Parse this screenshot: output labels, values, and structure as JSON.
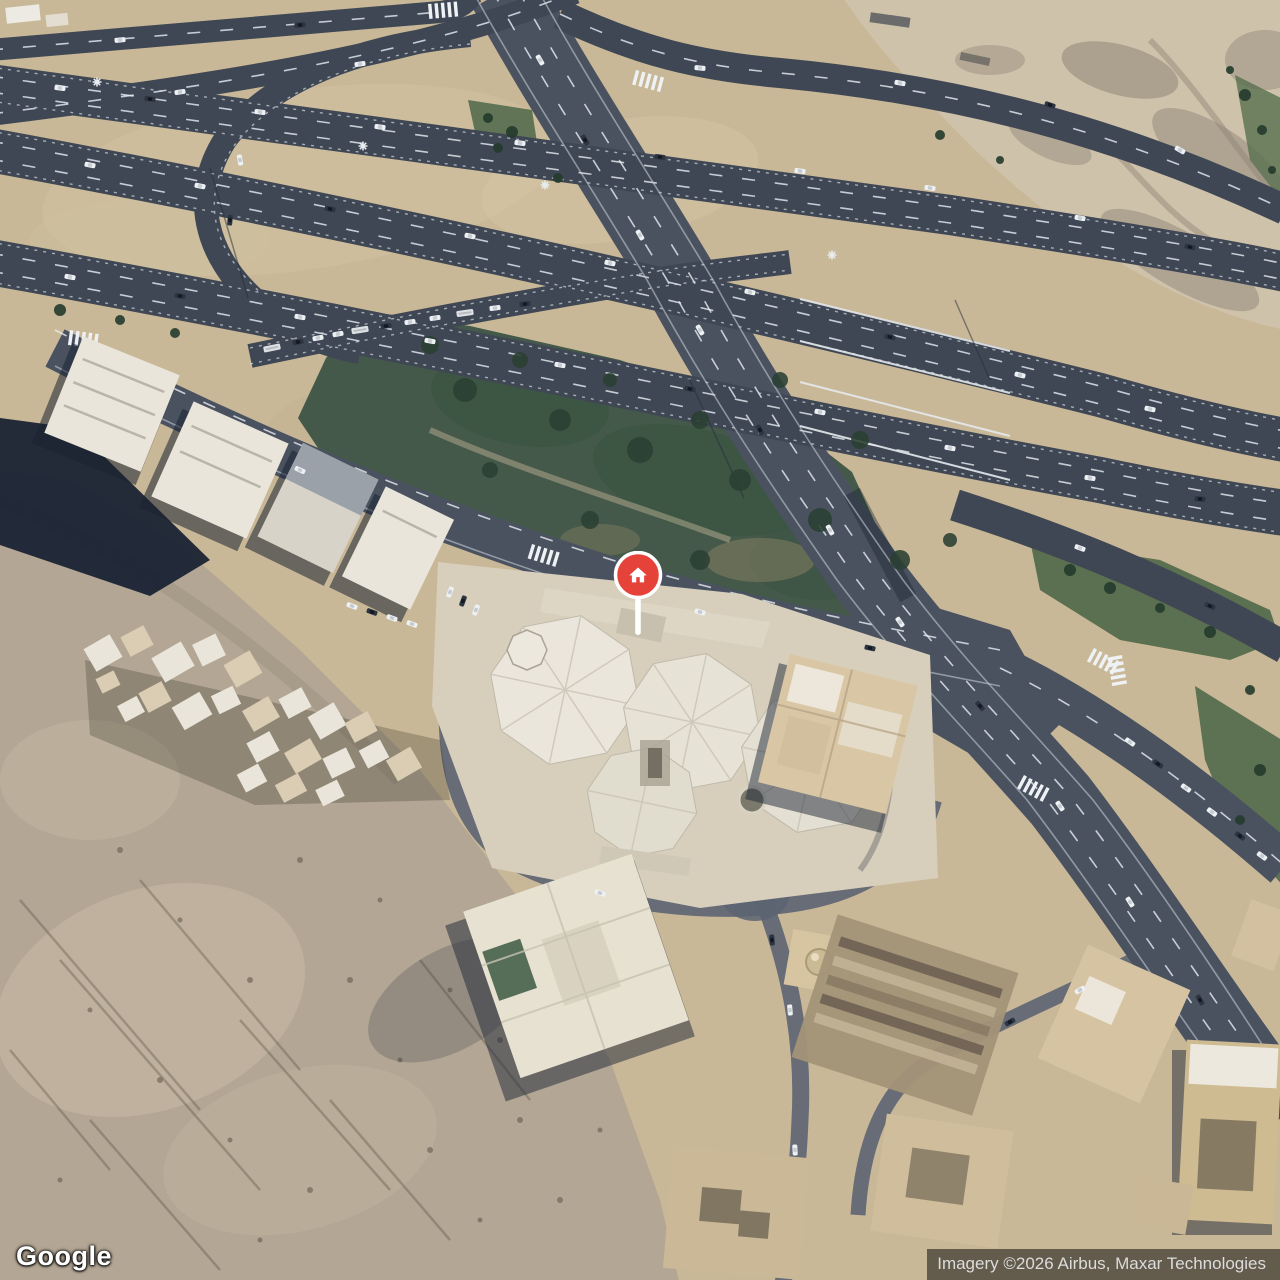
{
  "map": {
    "kind": "satellite",
    "marker": {
      "name": "home-pin",
      "color": "#E5433A",
      "glyph": "home"
    }
  },
  "footer": {
    "logo": "Google",
    "attribution": "Imagery ©2026 Airbus, Maxar Technologies"
  },
  "palette": {
    "sand-base": "#c9b897",
    "sand-pale": "#cfc2ab",
    "rock": "#b3a694",
    "asphalt": "#3f4754",
    "asphalt-light": "#4a5260",
    "lane": "#e8edf2",
    "park": "#44594a",
    "tree": "#2a4033",
    "shadow": "#161e30",
    "bldg-white": "#e9e5da",
    "bldg-tan": "#d6c3a2",
    "plaza": "#d7cfbc",
    "pin-red": "#E5433A"
  }
}
